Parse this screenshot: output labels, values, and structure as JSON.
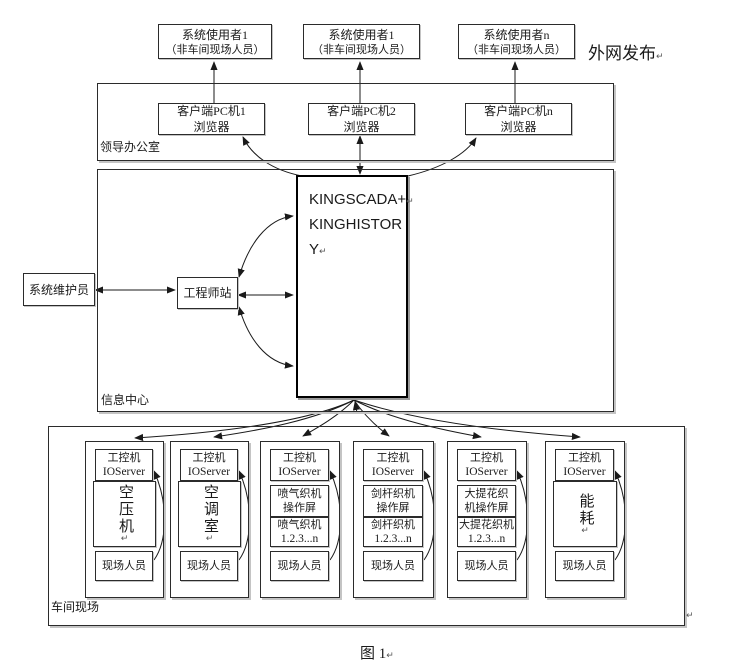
{
  "marks": {
    "return": "↵"
  },
  "external": {
    "label": "外网发布"
  },
  "users": [
    {
      "line1": "系统使用者1",
      "line2": "（非车间现场人员）"
    },
    {
      "line1": "系统使用者1",
      "line2": "（非车间现场人员）"
    },
    {
      "line1": "系统使用者n",
      "line2": "（非车间现场人员）"
    }
  ],
  "office": {
    "label": "领导办公室",
    "clients": [
      {
        "line1": "客户端PC机1",
        "line2": "浏览器"
      },
      {
        "line1": "客户端PC机2",
        "line2": "浏览器"
      },
      {
        "line1": "客户端PC机n",
        "line2": "浏览器"
      }
    ]
  },
  "info_center": {
    "label": "信息中心",
    "server_lines": [
      "KINGSCADA+",
      "KINGHISTOR",
      "Y"
    ],
    "engineer_station": "工程师站",
    "maintainer": "系统维护员"
  },
  "workshop": {
    "label": "车间现场",
    "columns": [
      {
        "pc": "工控机",
        "io": "IOServer",
        "device": "空压机",
        "person": "现场人员"
      },
      {
        "pc": "工控机",
        "io": "IOServer",
        "device": "空调室",
        "person": "现场人员"
      },
      {
        "pc": "工控机",
        "io": "IOServer",
        "screen1": "喷气织机",
        "screen2": "操作屏",
        "units1": "喷气织机",
        "units2": "1.2.3...n",
        "person": "现场人员"
      },
      {
        "pc": "工控机",
        "io": "IOServer",
        "screen1": "剑杆织机",
        "screen2": "操作屏",
        "units1": "剑杆织机",
        "units2": "1.2.3...n",
        "person": "现场人员"
      },
      {
        "pc": "工控机",
        "io": "IOServer",
        "screen1": "大提花织",
        "screen2": "机操作屏",
        "units1": "大提花织机",
        "units2": "1.2.3...n",
        "person": "现场人员"
      },
      {
        "pc": "工控机",
        "io": "IOServer",
        "device": "能耗",
        "person": "现场人员"
      }
    ]
  },
  "caption": {
    "text": "图 1"
  }
}
